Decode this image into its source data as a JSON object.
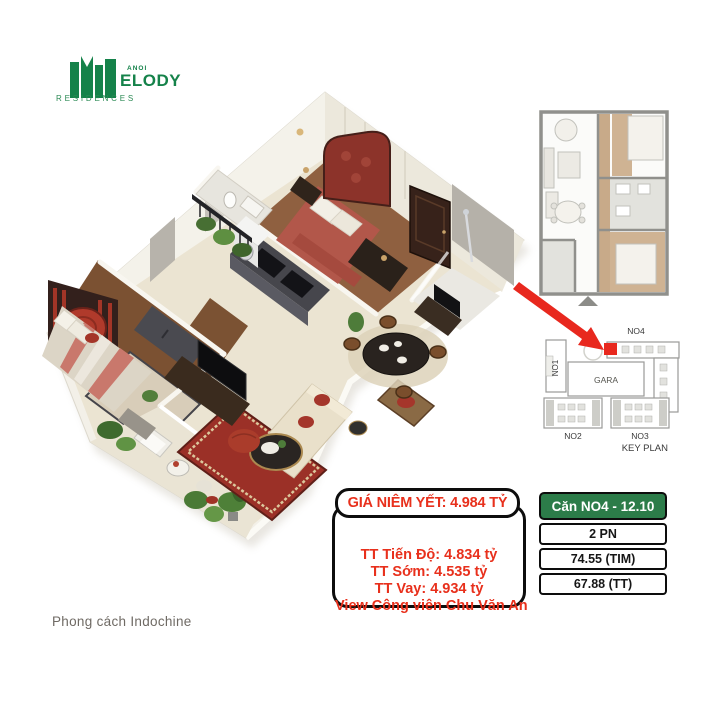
{
  "brand": {
    "name_small": "ANOI",
    "name_big": "ELODY",
    "subtitle": "RESIDENCES",
    "color": "#15824a"
  },
  "pricing": {
    "header": "GIÁ NIÊM YẾT: 4.984 TỶ",
    "lines": [
      "TT Tiến Độ: 4.834 tỷ",
      "TT Sớm: 4.535 tỷ",
      "TT Vay: 4.934 tỷ",
      "View Công viên Chu Văn An"
    ],
    "text_color": "#e8301c"
  },
  "unit_info": {
    "title": "Căn NO4 - 12.10",
    "rows": [
      "2 PN",
      "74.55 (TIM)",
      "67.88 (TT)"
    ],
    "header_bg": "#2c7c49"
  },
  "key_plan": {
    "no1": "NO1",
    "no2": "NO2",
    "no3": "NO3",
    "no4": "NO4",
    "gara": "GARA",
    "title": "KEY PLAN",
    "marker_color": "#e8281e"
  },
  "caption": "Phong cách Indochine"
}
